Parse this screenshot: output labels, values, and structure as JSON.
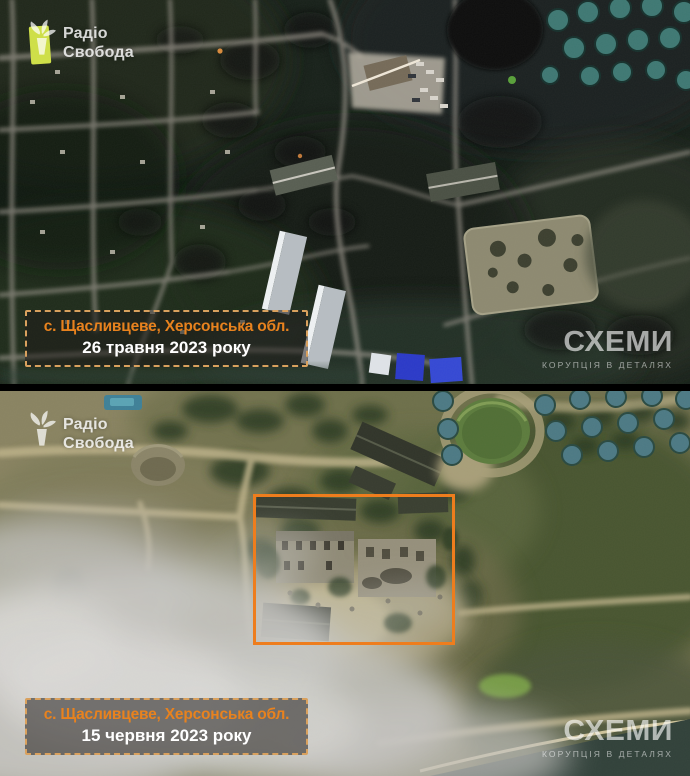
{
  "panels": [
    {
      "id": "before",
      "logo": {
        "line1": "Радіо",
        "line2": "Свобода"
      },
      "label": {
        "location": "с. Щасливцеве, Херсонська обл.",
        "date": "26 травня 2023 року"
      },
      "watermark": {
        "title": "СХЕМИ",
        "subtitle": "КОРУПЦІЯ В ДЕТАЛЯХ"
      }
    },
    {
      "id": "after",
      "logo": {
        "line1": "Радіо",
        "line2": "Свобода"
      },
      "label": {
        "location": "с. Щасливцеве, Херсонська обл.",
        "date": "15 червня 2023 року"
      },
      "watermark": {
        "title": "СХЕМИ",
        "subtitle": "КОРУПЦІЯ В ДЕТАЛЯХ"
      }
    }
  ],
  "icons": {
    "logo_icon": "torch-icon (Radio Svoboda torch/flame mark)"
  },
  "colors": {
    "accent_orange": "#E8821E",
    "highlight_box": "#EE7D1D",
    "label_border": "#D9A15E",
    "label_bg": "rgba(33,30,27,0.55)",
    "date_text": "#FFFFFF",
    "watermark_text": "rgba(255,255,255,0.62)"
  }
}
